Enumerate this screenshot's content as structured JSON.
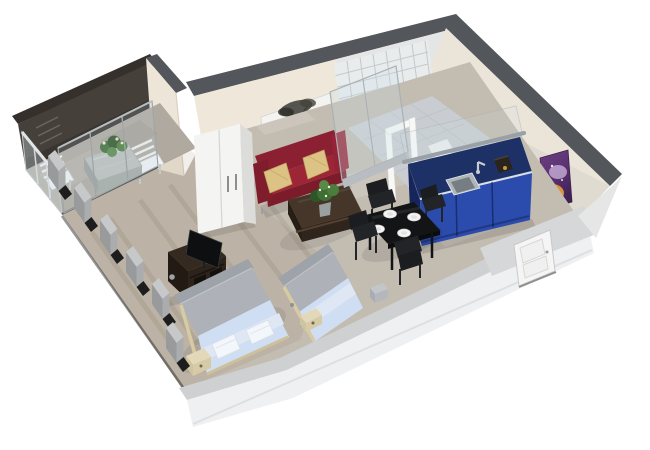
{
  "scene": {
    "type": "3d-floor-plan-render",
    "background": "#ffffff",
    "rooms": [
      "balcony",
      "living-area",
      "sleeping-area",
      "bathroom",
      "kitchen",
      "dining-area",
      "entrance"
    ]
  },
  "objects": {
    "wall_art": [
      "black-white-tree-photo",
      "purple-abstract-painting"
    ],
    "furniture": [
      "white-wardrobe",
      "red-sofa",
      "gold-pillows",
      "coffee-table",
      "potted-plant",
      "tv-cabinet",
      "flat-tv",
      "double-bed",
      "single-bed",
      "nightstand",
      "dining-table",
      "dining-chairs",
      "kitchen-counter",
      "kitchen-sink",
      "toilet",
      "shower",
      "balcony-table",
      "balcony-chairs",
      "front-door",
      "sliding-glass-doors",
      "glass-railing",
      "window-wall-cutaway"
    ],
    "counts": {
      "beds": 2,
      "dining_chairs": 4,
      "balcony_chairs": 2,
      "paintings": 2
    }
  },
  "colors": {
    "background": "#ffffff",
    "wallTop": "#53565a",
    "wallCream": "#efe8da",
    "bathWall": "#e3e5e7",
    "balconyWall": "#46403a",
    "rightWall": "#eae4d9",
    "floorMain": "#c3bcb1",
    "floorBalcony": "#b0a99f",
    "floorBath": "#c9cdd1",
    "tile": "#e9eced",
    "sofa": "#8a2031",
    "sofaSeat": "#9c2536",
    "pillow": "#ddc285",
    "coffeeTable": "#46362a",
    "wardrobe": "#f4f4f3",
    "treeCanvas": "#f3f3f1",
    "artPurple": "#5d3373",
    "artOrange": "#e29a3f",
    "tvUnit": "#352a20",
    "tvScreen": "#0e0f11",
    "headboard": "#9ea3a9",
    "duvetGray": "#aeb2b8",
    "bedBlue": "#cfdef2",
    "sheetLight": "#dee7f3",
    "frameTan": "#e3d9b8",
    "diningTable": "#131416",
    "chair": "#1c1d20",
    "plate": "#f4f4f4",
    "kitchenTop": "#1d3166",
    "kitchenFront": "#2b4bad",
    "sinkGray": "#aeb6ba",
    "toilet": "#f4f6f7",
    "door": "#f5f5f5",
    "doorWall": "#d6d7d8",
    "frontWall": "#eff0f1",
    "frontWallTop": "#cfd0d1",
    "stub": "#989a9c",
    "stubTop": "#c7c8c9",
    "glass": "#cfe0e8",
    "plant": "#3f6e35",
    "stone": "#bcc0bc"
  }
}
